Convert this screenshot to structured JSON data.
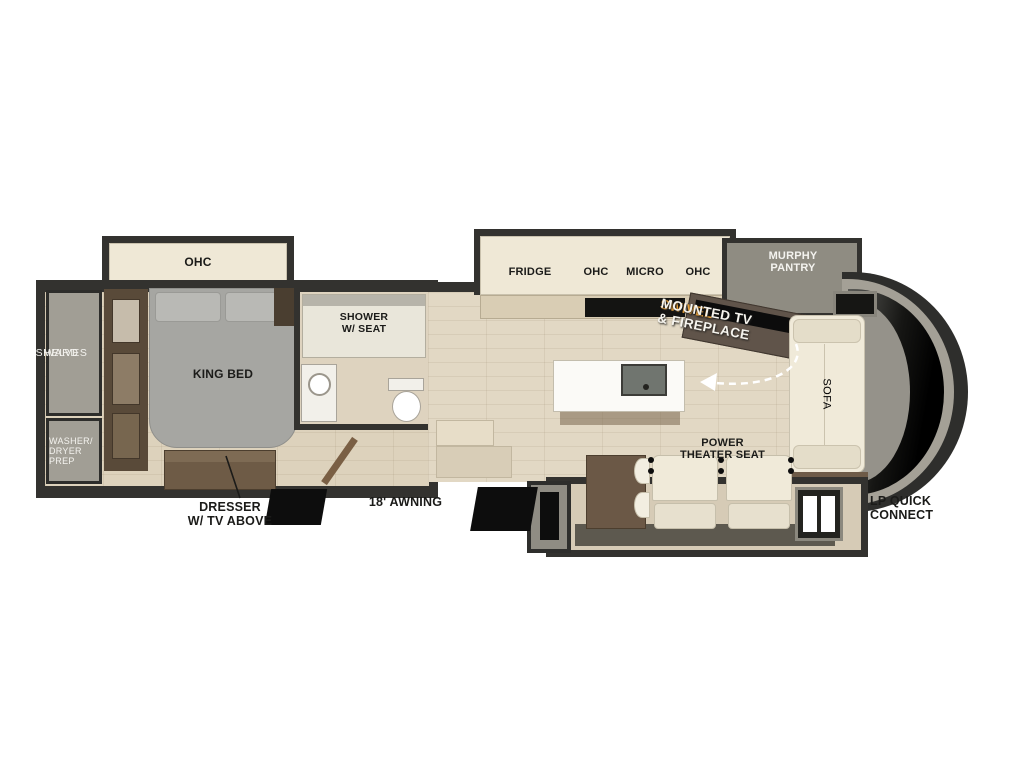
{
  "diagram": {
    "type": "rv-fifth-wheel-floorplan",
    "labels": {
      "bedroom_ohc": "OHC",
      "ward": "WARD",
      "shelves": "SHELVES",
      "washer_dryer_prep": "WASHER/\nDRYER\nPREP",
      "king_bed": "KING BED",
      "dresser_tv": "DRESSER\nW/ TV ABOVE",
      "shower_seat": "SHOWER\nW/ SEAT",
      "closet_ohc": "OHC",
      "closet": "CLOSET",
      "drawers": "DRAWERS",
      "fridge": "FRIDGE",
      "kitchen_ohc_left": "OHC",
      "micro": "MICRO",
      "kitchen_ohc_right": "OHC",
      "murphy_pantry": "MURPHY\nPANTRY",
      "swivel_highlight": "SWIVEL",
      "swivel_rest": "MOUNTED TV\n& FIREPLACE",
      "sofa": "SOFA",
      "power_theater_seat": "POWER\nTHEATER SEAT",
      "awning": "18' AWNING",
      "lp_quick_connect": "LP QUICK\nCONNECT"
    },
    "colors": {
      "wall": "#33322f",
      "floor_plank": "#ddd2bc",
      "cabinet_cream": "#efe8d6",
      "compartment_gray": "#a19e95",
      "wood_brown": "#63523f",
      "bed_gray": "#a6a6a2",
      "swivel_accent_orange": "#f2a73b",
      "step_black": "#0d0d0d"
    },
    "icons": {
      "arrow": "curved-dashed-swivel-arrow-icon",
      "pointer": "dresser-pointer-line-icon"
    }
  }
}
